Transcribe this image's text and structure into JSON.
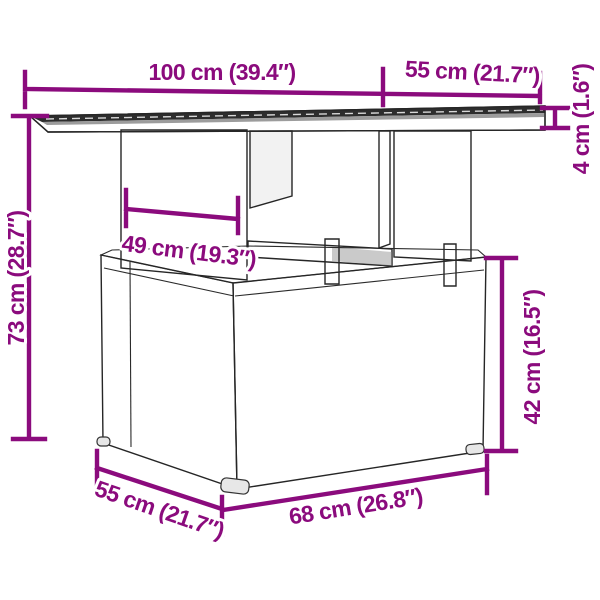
{
  "figure": {
    "kind": "product-dimension-diagram",
    "subject": "poly-rattan garden table with glass top and footstool, perspective line drawing",
    "colors": {
      "dimension_accent": "#8B0B7D",
      "outline": "#262626",
      "glass_top": "#2d2d2d",
      "glass_highlight": "#9c9c9c",
      "wicker_stroke": "#3d3d3d",
      "background": "#ffffff"
    },
    "dimensions": [
      {
        "id": "tabletop-width",
        "label": "100 cm (39.4″)"
      },
      {
        "id": "tabletop-depth",
        "label": "55 cm (21.7″)"
      },
      {
        "id": "tabletop-thickness",
        "label": "4 cm (1.6″)"
      },
      {
        "id": "table-height",
        "label": "73 cm (28.7″)"
      },
      {
        "id": "leg-panel-width",
        "label": "49 cm (19.3″)"
      },
      {
        "id": "footstool-height",
        "label": "42 cm (16.5″)"
      },
      {
        "id": "footstool-depth",
        "label": "55 cm (21.7″)"
      },
      {
        "id": "footstool-width",
        "label": "68 cm (26.8″)"
      }
    ]
  }
}
